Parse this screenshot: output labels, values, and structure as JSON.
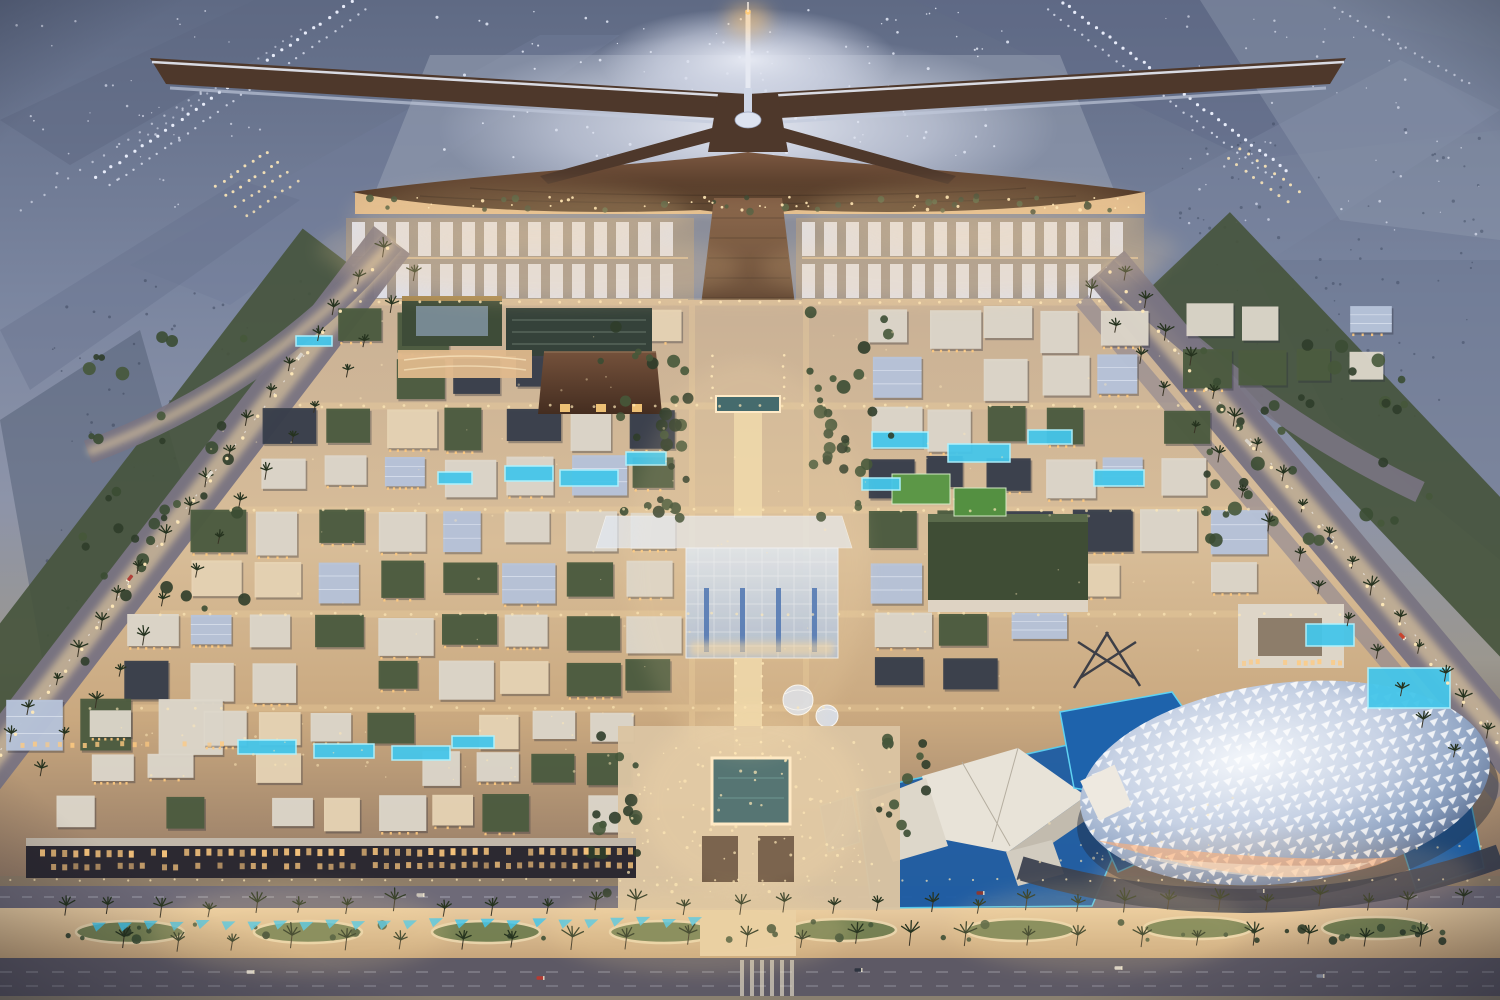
{
  "meta": {
    "scene": "Aerial dusk rendering of an airport city masterplan",
    "landmarks": [
      "x-shaped-terminal",
      "control-tower",
      "parking-canopies",
      "central-glass-souq",
      "reflecting-pool-plaza",
      "lattice-dome-arena",
      "museum-complex",
      "villa-district",
      "palm-boulevard",
      "runways"
    ]
  },
  "palette": {
    "light_warm": "#ffe9b8",
    "light_cool": "#eef2ff",
    "scrub": "#39445a",
    "terminal_roof": "#4e382b",
    "canopy_white": "#dfe3ee",
    "green_roof": "#4c5c40",
    "roof_white": "#ddd6ca",
    "roof_dark": "#383e4b",
    "wall_warm": "#e6d3b4",
    "glass_cool": "#b7c4da",
    "window_warm": "#ffca80",
    "pool_cyan": "#45c6ea",
    "pool_glow": "#aef2ff",
    "palm_dark": "#26331f",
    "road_glow": "#ffe2a6"
  },
  "scene": {
    "canvas": {
      "w": 1500,
      "h": 1000
    },
    "runway_light_lines": [
      {
        "x1": 352,
        "y1": 2,
        "x2": 96,
        "y2": 178,
        "n": 34,
        "r": 1.6,
        "c": "light_cool",
        "o": 0.95
      },
      {
        "x1": 366,
        "y1": 10,
        "x2": 110,
        "y2": 186,
        "n": 34,
        "r": 1.2,
        "c": "light_cool",
        "o": 0.7
      },
      {
        "x1": 300,
        "y1": 30,
        "x2": 140,
        "y2": 140,
        "n": 20,
        "r": 1.1,
        "c": "light_cool",
        "o": 0.5
      },
      {
        "x1": 216,
        "y1": 186,
        "x2": 268,
        "y2": 152,
        "n": 8,
        "r": 1.5,
        "c": "light_warm",
        "o": 0.9
      },
      {
        "x1": 226,
        "y1": 196,
        "x2": 278,
        "y2": 162,
        "n": 8,
        "r": 1.5,
        "c": "light_warm",
        "o": 0.9
      },
      {
        "x1": 236,
        "y1": 206,
        "x2": 288,
        "y2": 172,
        "n": 8,
        "r": 1.4,
        "c": "light_warm",
        "o": 0.85
      },
      {
        "x1": 246,
        "y1": 216,
        "x2": 298,
        "y2": 182,
        "n": 8,
        "r": 1.4,
        "c": "light_warm",
        "o": 0.8
      },
      {
        "x1": 1062,
        "y1": 2,
        "x2": 1286,
        "y2": 170,
        "n": 34,
        "r": 1.6,
        "c": "light_cool",
        "o": 0.95
      },
      {
        "x1": 1048,
        "y1": 10,
        "x2": 1272,
        "y2": 178,
        "n": 34,
        "r": 1.2,
        "c": "light_cool",
        "o": 0.7
      },
      {
        "x1": 1240,
        "y1": 148,
        "x2": 1300,
        "y2": 192,
        "n": 8,
        "r": 1.5,
        "c": "light_warm",
        "o": 0.9
      },
      {
        "x1": 1228,
        "y1": 158,
        "x2": 1288,
        "y2": 202,
        "n": 8,
        "r": 1.5,
        "c": "light_warm",
        "o": 0.85
      },
      {
        "x1": 1334,
        "y1": 8,
        "x2": 1470,
        "y2": 84,
        "n": 18,
        "r": 1.2,
        "c": "light_cool",
        "o": 0.6
      },
      {
        "x1": 20,
        "y1": 210,
        "x2": 200,
        "y2": 92,
        "n": 16,
        "r": 1.2,
        "c": "light_cool",
        "o": 0.55
      }
    ],
    "dot_fields": [
      {
        "x": 430,
        "y": 8,
        "w": 600,
        "h": 150,
        "n": 110,
        "r": 1.1,
        "c": "light_cool",
        "o": 0.8,
        "seed": 7
      },
      {
        "x": 10,
        "y": 10,
        "w": 260,
        "h": 200,
        "n": 46,
        "r": 1.0,
        "c": "light_cool",
        "o": 0.6,
        "seed": 11
      },
      {
        "x": 1150,
        "y": 10,
        "w": 330,
        "h": 230,
        "n": 60,
        "r": 1.0,
        "c": "light_cool",
        "o": 0.6,
        "seed": 13
      },
      {
        "x": 40,
        "y": 280,
        "w": 420,
        "h": 420,
        "n": 130,
        "r": 1.2,
        "c": "scrub",
        "o": 0.5,
        "seed": 17
      },
      {
        "x": 1180,
        "y": 120,
        "w": 310,
        "h": 300,
        "n": 90,
        "r": 1.2,
        "c": "scrub",
        "o": 0.45,
        "seed": 19
      }
    ],
    "city_dot_fields": [
      {
        "x": 628,
        "y": 740,
        "w": 262,
        "h": 152,
        "n": 110,
        "r": 1.2,
        "c": "light_warm",
        "o": 0.7,
        "seed": 109
      },
      {
        "x": 380,
        "y": 196,
        "w": 756,
        "h": 14,
        "n": 44,
        "r": 1.3,
        "c": "light_warm",
        "o": 0.9,
        "seed": 111
      },
      {
        "x": 100,
        "y": 712,
        "w": 540,
        "h": 68,
        "n": 44,
        "r": 1.1,
        "c": "light_warm",
        "o": 0.5,
        "seed": 113
      },
      {
        "x": 1040,
        "y": 790,
        "w": 200,
        "h": 70,
        "n": 24,
        "r": 1.1,
        "c": "light_warm",
        "o": 0.5,
        "seed": 115
      },
      {
        "x": 200,
        "y": 320,
        "w": 1000,
        "h": 360,
        "n": 90,
        "r": 1.0,
        "c": "light_warm",
        "o": 0.4,
        "seed": 117
      }
    ],
    "parking": {
      "bands": [
        {
          "x": 352,
          "y": 222,
          "w": 336
        },
        {
          "x": 802,
          "y": 222,
          "w": 336
        }
      ],
      "rows": 2,
      "rowH": 34,
      "gapY": 8,
      "stripW": 13,
      "stripGap": 9
    },
    "districts": [
      {
        "x": 332,
        "y": 306,
        "w": 356,
        "h": 94,
        "cols": 6,
        "rows": 2,
        "pal": "mix",
        "seed": 201,
        "skip": 0.1
      },
      {
        "x": 866,
        "y": 304,
        "w": 286,
        "h": 96,
        "cols": 5,
        "rows": 2,
        "pal": "mix",
        "seed": 203,
        "skip": 0.1
      },
      {
        "x": 258,
        "y": 404,
        "w": 430,
        "h": 98,
        "cols": 7,
        "rows": 2,
        "pal": "mix",
        "seed": 205,
        "skip": 0.1
      },
      {
        "x": 866,
        "y": 404,
        "w": 350,
        "h": 98,
        "cols": 6,
        "rows": 2,
        "pal": "mix",
        "seed": 207,
        "skip": 0.1
      },
      {
        "x": 188,
        "y": 506,
        "w": 498,
        "h": 102,
        "cols": 8,
        "rows": 2,
        "pal": "mix",
        "seed": 209,
        "skip": 0.12
      },
      {
        "x": 866,
        "y": 506,
        "w": 406,
        "h": 102,
        "cols": 6,
        "rows": 2,
        "pal": "mix",
        "seed": 211,
        "skip": 0.12
      },
      {
        "x": 122,
        "y": 612,
        "w": 564,
        "h": 90,
        "cols": 9,
        "rows": 2,
        "pal": "mix",
        "seed": 213,
        "skip": 0.12
      },
      {
        "x": 868,
        "y": 610,
        "w": 206,
        "h": 90,
        "cols": 3,
        "rows": 2,
        "pal": "mix",
        "seed": 215,
        "skip": 0.1
      },
      {
        "x": 2,
        "y": 694,
        "w": 228,
        "h": 70,
        "cols": 3,
        "rows": 1,
        "pal": "office",
        "seed": 217,
        "skip": 0
      },
      {
        "x": 86,
        "y": 708,
        "w": 554,
        "h": 80,
        "cols": 10,
        "rows": 2,
        "pal": "villa",
        "seed": 219,
        "skip": 0.12
      },
      {
        "x": 54,
        "y": 792,
        "w": 584,
        "h": 44,
        "cols": 11,
        "rows": 1,
        "pal": "villa",
        "seed": 221,
        "skip": 0.1
      },
      {
        "x": 1180,
        "y": 300,
        "w": 220,
        "h": 90,
        "cols": 4,
        "rows": 2,
        "pal": "office",
        "seed": 223,
        "skip": 0.2
      }
    ],
    "palettes": {
      "mix": [
        "green_roof",
        "green_roof",
        "roof_white",
        "roof_dark",
        "wall_warm",
        "glass_cool",
        "roof_white"
      ],
      "villa": [
        "roof_white",
        "roof_white",
        "wall_warm",
        "green_roof"
      ],
      "office": [
        "green_roof",
        "roof_white",
        "glass_cool"
      ]
    },
    "pools": [
      {
        "x": 505,
        "y": 466,
        "w": 48,
        "h": 15
      },
      {
        "x": 560,
        "y": 470,
        "w": 58,
        "h": 16
      },
      {
        "x": 626,
        "y": 452,
        "w": 40,
        "h": 13
      },
      {
        "x": 438,
        "y": 472,
        "w": 34,
        "h": 12
      },
      {
        "x": 872,
        "y": 432,
        "w": 56,
        "h": 16
      },
      {
        "x": 948,
        "y": 444,
        "w": 62,
        "h": 18
      },
      {
        "x": 1028,
        "y": 430,
        "w": 44,
        "h": 14
      },
      {
        "x": 1094,
        "y": 470,
        "w": 50,
        "h": 16
      },
      {
        "x": 862,
        "y": 478,
        "w": 38,
        "h": 12
      },
      {
        "x": 296,
        "y": 336,
        "w": 36,
        "h": 10
      },
      {
        "x": 238,
        "y": 740,
        "w": 58,
        "h": 14
      },
      {
        "x": 314,
        "y": 744,
        "w": 60,
        "h": 14
      },
      {
        "x": 392,
        "y": 746,
        "w": 58,
        "h": 14
      },
      {
        "x": 452,
        "y": 736,
        "w": 42,
        "h": 12
      },
      {
        "x": 1368,
        "y": 668,
        "w": 82,
        "h": 40
      },
      {
        "x": 1306,
        "y": 624,
        "w": 48,
        "h": 22
      }
    ],
    "street_light_rows": [
      {
        "x1": 360,
        "y1": 302,
        "x2": 1140,
        "y2": 302,
        "n": 40,
        "r": 1.4,
        "c": "light_warm",
        "o": 0.8
      },
      {
        "x1": 300,
        "y1": 406,
        "x2": 1200,
        "y2": 406,
        "n": 44,
        "r": 1.4,
        "c": "light_warm",
        "o": 0.7
      },
      {
        "x1": 230,
        "y1": 510,
        "x2": 1272,
        "y2": 510,
        "n": 46,
        "r": 1.4,
        "c": "light_warm",
        "o": 0.7
      },
      {
        "x1": 160,
        "y1": 614,
        "x2": 1340,
        "y2": 614,
        "n": 48,
        "r": 1.4,
        "c": "light_warm",
        "o": 0.65
      },
      {
        "x1": 90,
        "y1": 708,
        "x2": 1060,
        "y2": 708,
        "n": 38,
        "r": 1.4,
        "c": "light_warm",
        "o": 0.6
      },
      {
        "x1": 388,
        "y1": 248,
        "x2": -16,
        "y2": 776,
        "n": 26,
        "r": 1.7,
        "c": "light_warm",
        "o": 0.95
      },
      {
        "x1": 1110,
        "y1": 272,
        "x2": 1512,
        "y2": 762,
        "n": 26,
        "r": 1.7,
        "c": "light_warm",
        "o": 0.95
      },
      {
        "x1": 10,
        "y1": 880,
        "x2": 1490,
        "y2": 880,
        "n": 64,
        "r": 1.1,
        "c": "light_warm",
        "o": 0.7
      },
      {
        "x1": 736,
        "y1": 664,
        "x2": 736,
        "y2": 754,
        "n": 8,
        "r": 1.3,
        "c": "light_warm",
        "o": 0.85
      },
      {
        "x1": 762,
        "y1": 664,
        "x2": 762,
        "y2": 754,
        "n": 8,
        "r": 1.3,
        "c": "light_warm",
        "o": 0.85
      },
      {
        "x1": 712,
        "y1": 356,
        "x2": 712,
        "y2": 398,
        "n": 5,
        "r": 1.3,
        "c": "light_warm",
        "o": 0.85
      },
      {
        "x1": 784,
        "y1": 356,
        "x2": 784,
        "y2": 398,
        "n": 5,
        "r": 1.3,
        "c": "light_warm",
        "o": 0.85
      },
      {
        "x1": 1040,
        "y1": 862,
        "x2": 1480,
        "y2": 846,
        "n": 22,
        "r": 1.2,
        "c": "light_warm",
        "o": 0.6
      }
    ],
    "tree_clusters": [
      {
        "x": 600,
        "y": 300,
        "w": 92,
        "h": 150,
        "n": 18,
        "rmin": 3,
        "rmax": 7,
        "seed": 31
      },
      {
        "x": 800,
        "y": 300,
        "w": 92,
        "h": 150,
        "n": 18,
        "rmin": 3,
        "rmax": 7,
        "seed": 37
      },
      {
        "x": 588,
        "y": 736,
        "w": 56,
        "h": 164,
        "n": 16,
        "rmin": 3,
        "rmax": 7,
        "seed": 41
      },
      {
        "x": 876,
        "y": 738,
        "w": 50,
        "h": 96,
        "n": 12,
        "rmin": 3,
        "rmax": 6,
        "seed": 43
      },
      {
        "x": 1190,
        "y": 340,
        "w": 240,
        "h": 210,
        "n": 42,
        "rmin": 3,
        "rmax": 7,
        "seed": 53
      },
      {
        "x": 60,
        "y": 330,
        "w": 190,
        "h": 340,
        "n": 36,
        "rmin": 3,
        "rmax": 7,
        "seed": 59
      },
      {
        "x": 360,
        "y": 196,
        "w": 776,
        "h": 16,
        "n": 30,
        "rmin": 2,
        "rmax": 4,
        "seed": 61
      },
      {
        "x": 50,
        "y": 920,
        "w": 1400,
        "h": 22,
        "n": 40,
        "rmin": 2,
        "rmax": 5,
        "seed": 107
      },
      {
        "x": 620,
        "y": 430,
        "w": 70,
        "h": 90,
        "n": 12,
        "rmin": 3,
        "rmax": 6,
        "seed": 63
      },
      {
        "x": 806,
        "y": 430,
        "w": 70,
        "h": 90,
        "n": 12,
        "rmin": 3,
        "rmax": 6,
        "seed": 65
      }
    ],
    "palm_rows": [
      {
        "x1": 60,
        "y1": 916,
        "x2": 1460,
        "y2": 908,
        "n": 30,
        "s": 11,
        "seed": 67
      },
      {
        "x1": 120,
        "y1": 950,
        "x2": 1420,
        "y2": 944,
        "n": 24,
        "s": 12,
        "seed": 71
      },
      {
        "x1": 380,
        "y1": 255,
        "x2": 10,
        "y2": 745,
        "n": 18,
        "s": 9,
        "seed": 73
      },
      {
        "x1": 418,
        "y1": 278,
        "x2": 40,
        "y2": 775,
        "n": 16,
        "s": 9,
        "seed": 79
      },
      {
        "x1": 1122,
        "y1": 282,
        "x2": 1488,
        "y2": 738,
        "n": 17,
        "s": 9,
        "seed": 83
      },
      {
        "x1": 1086,
        "y1": 300,
        "x2": 1452,
        "y2": 760,
        "n": 15,
        "s": 9,
        "seed": 89
      }
    ],
    "cyan_canopies": {
      "x1": 92,
      "y1": 922,
      "x2": 688,
      "y2": 918,
      "n": 24,
      "w": 14,
      "h": 9
    },
    "window_rows": [
      {
        "x1": 40,
        "y1": 850,
        "x2": 628,
        "y2": 848,
        "n": 54,
        "w": 5,
        "h": 7,
        "o": 0.95,
        "seed": 97
      },
      {
        "x1": 40,
        "y1": 864,
        "x2": 628,
        "y2": 862,
        "n": 54,
        "w": 5,
        "h": 6,
        "o": 0.8,
        "seed": 101
      },
      {
        "x1": 1242,
        "y1": 660,
        "x2": 1338,
        "y2": 660,
        "n": 15,
        "w": 4,
        "h": 5,
        "o": 0.9,
        "seed": 103
      },
      {
        "x1": 8,
        "y1": 742,
        "x2": 220,
        "y2": 742,
        "n": 18,
        "w": 4,
        "h": 5,
        "o": 0.85,
        "seed": 105
      }
    ],
    "cars": [
      {
        "x": 250,
        "y": 972,
        "rot": 0,
        "c": "#e8e2d8"
      },
      {
        "x": 540,
        "y": 978,
        "rot": 0,
        "c": "#b43a32"
      },
      {
        "x": 858,
        "y": 970,
        "rot": 0,
        "c": "#2e3440"
      },
      {
        "x": 1118,
        "y": 968,
        "rot": 0,
        "c": "#d8d2c8"
      },
      {
        "x": 1320,
        "y": 976,
        "rot": 0,
        "c": "#8a8fa0"
      },
      {
        "x": 420,
        "y": 895,
        "rot": 0,
        "c": "#c8c2b8"
      },
      {
        "x": 980,
        "y": 893,
        "rot": 0,
        "c": "#8a3430"
      },
      {
        "x": 1260,
        "y": 891,
        "rot": 0,
        "c": "#3a4254"
      },
      {
        "x": 210,
        "y": 474,
        "rot": 128,
        "c": "#e0dace"
      },
      {
        "x": 130,
        "y": 578,
        "rot": 128,
        "c": "#b04038"
      },
      {
        "x": 300,
        "y": 356,
        "rot": 128,
        "c": "#d8d2c8"
      },
      {
        "x": 1248,
        "y": 442,
        "rot": 46,
        "c": "#d8d2c8"
      },
      {
        "x": 1330,
        "y": 540,
        "rot": 46,
        "c": "#384050"
      },
      {
        "x": 1402,
        "y": 636,
        "rot": 46,
        "c": "#c8442e"
      }
    ],
    "glow_spots": [
      {
        "x": 748,
        "y": 20,
        "rx": 22,
        "ry": 15,
        "c": "#ffc878",
        "o": 0.55
      },
      {
        "x": 748,
        "y": 250,
        "rx": 430,
        "ry": 54,
        "c": "#ffd9a0",
        "o": 0.17
      },
      {
        "x": 520,
        "y": 214,
        "rx": 170,
        "ry": 30,
        "c": "#ffd9a0",
        "o": 0.2
      },
      {
        "x": 976,
        "y": 214,
        "rx": 170,
        "ry": 30,
        "c": "#ffd9a0",
        "o": 0.2
      },
      {
        "x": 540,
        "y": 268,
        "rx": 200,
        "ry": 36,
        "c": "#ffd9a0",
        "o": 0.15
      },
      {
        "x": 960,
        "y": 268,
        "rx": 200,
        "ry": 36,
        "c": "#ffd9a0",
        "o": 0.15
      },
      {
        "x": 748,
        "y": 560,
        "rx": 120,
        "ry": 200,
        "c": "#ffe2b0",
        "o": 0.12
      },
      {
        "x": 752,
        "y": 802,
        "rx": 112,
        "ry": 92,
        "c": "#ffe2b0",
        "o": 0.2
      },
      {
        "x": 1285,
        "y": 874,
        "rx": 190,
        "ry": 40,
        "c": "#ffc890",
        "o": 0.16
      },
      {
        "x": 300,
        "y": 930,
        "rx": 150,
        "ry": 44,
        "c": "#ffdf9e",
        "o": 0.17
      },
      {
        "x": 700,
        "y": 930,
        "rx": 150,
        "ry": 44,
        "c": "#ffdf9e",
        "o": 0.17
      },
      {
        "x": 1100,
        "y": 928,
        "rx": 150,
        "ry": 44,
        "c": "#ffdf9e",
        "o": 0.17
      }
    ]
  }
}
